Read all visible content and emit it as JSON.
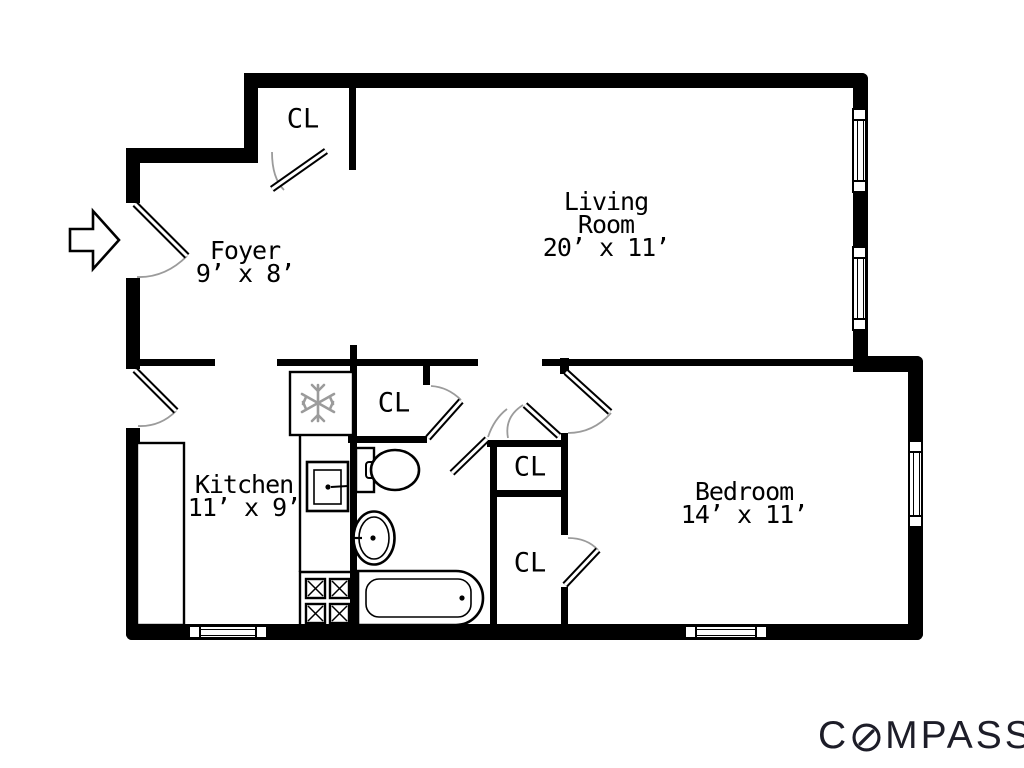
{
  "rooms": {
    "foyer": {
      "name": "Foyer",
      "dims": "9’ x 8’"
    },
    "living": {
      "name_line1": "Living",
      "name_line2": "Room",
      "dims": "20’ x 11’"
    },
    "kitchen": {
      "name": "Kitchen",
      "dims": "11’ x 9’"
    },
    "bedroom": {
      "name": "Bedroom",
      "dims": "14’ x 11’"
    }
  },
  "closets": {
    "foyer_closet": "CL",
    "kitchen_closet": "CL",
    "hall_closet_upper": "CL",
    "hall_closet_lower": "CL"
  },
  "branding": {
    "logo_prefix": "C",
    "logo_suffix": "MPASS",
    "logo_full": "COMPASS"
  },
  "colors": {
    "wall": "#000000",
    "door_arc": "#9b9b9b",
    "snowflake": "#9b9b9b",
    "logo": "#1d1d28"
  }
}
